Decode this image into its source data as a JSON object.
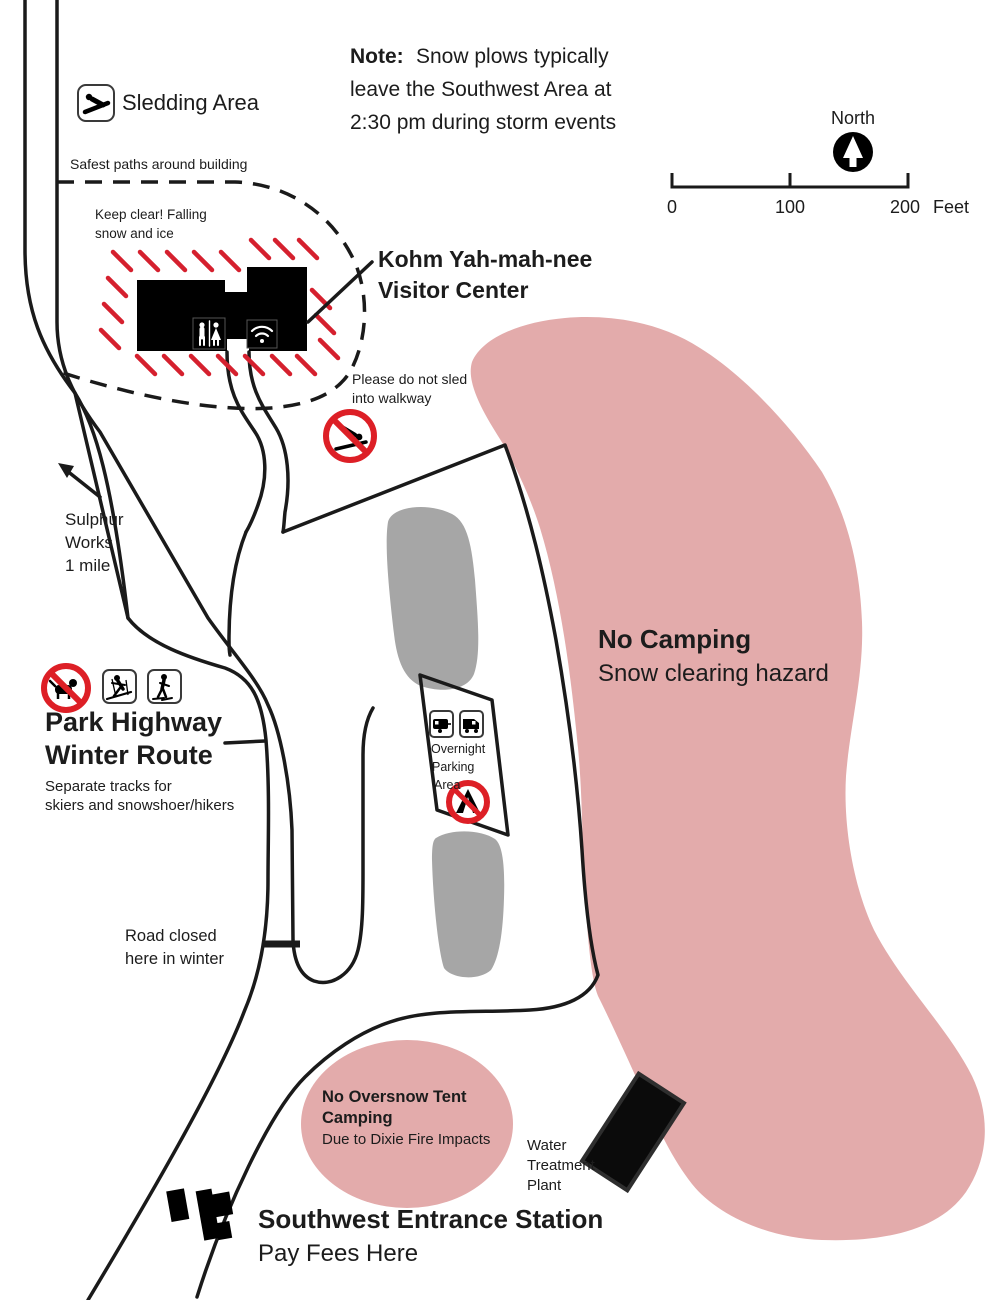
{
  "title": "Kohm Yah-mah-nee Visitor Center Southwest Area Winter Map",
  "note": {
    "prefix": "Note:",
    "line1": "Snow plows typically",
    "line2": "leave the Southwest Area at",
    "line3": "2:30 pm during storm events"
  },
  "compass": {
    "label": "North"
  },
  "scale_bar": {
    "tick0": "0",
    "tick100": "100",
    "tick200": "200",
    "unit": "Feet"
  },
  "sledding_area": {
    "label": "Sledding Area"
  },
  "safest_paths": {
    "label": "Safest paths around building"
  },
  "keep_clear": {
    "line1": "Keep clear! Falling",
    "line2": "snow and ice"
  },
  "visitor_center": {
    "line1": "Kohm Yah-mah-nee",
    "line2": "Visitor Center"
  },
  "no_sled_walkway": {
    "line1": "Please do not sled",
    "line2": "into walkway"
  },
  "sulphur_works": {
    "line1": "Sulphur",
    "line2": "Works",
    "line3": "1 mile"
  },
  "winter_route": {
    "line1": "Park Highway",
    "line2": "Winter Route",
    "sub1": "Separate tracks for",
    "sub2": "skiers and snowshoer/hikers"
  },
  "overnight_parking": {
    "line1": "Overnight",
    "line2": "Parking",
    "line3": "Area"
  },
  "no_camping": {
    "line1": "No Camping",
    "line2": "Snow clearing hazard"
  },
  "road_closed": {
    "line1": "Road closed",
    "line2": "here in winter"
  },
  "tent_camping": {
    "line1": "No Oversnow Tent",
    "line2": "Camping",
    "line3": "Due to Dixie Fire Impacts"
  },
  "water_plant": {
    "line1": "Water",
    "line2": "Treatment",
    "line3": "Plant"
  },
  "entrance_station": {
    "line1": "Southwest Entrance Station",
    "line2": "Pay Fees Here"
  },
  "colors": {
    "hazard_pink": "#e3abab",
    "snow_gray": "#a6a6a6",
    "warning_red": "#cf2030",
    "prohibition_red": "#dd1f26",
    "line_black": "#1a1a1a"
  }
}
